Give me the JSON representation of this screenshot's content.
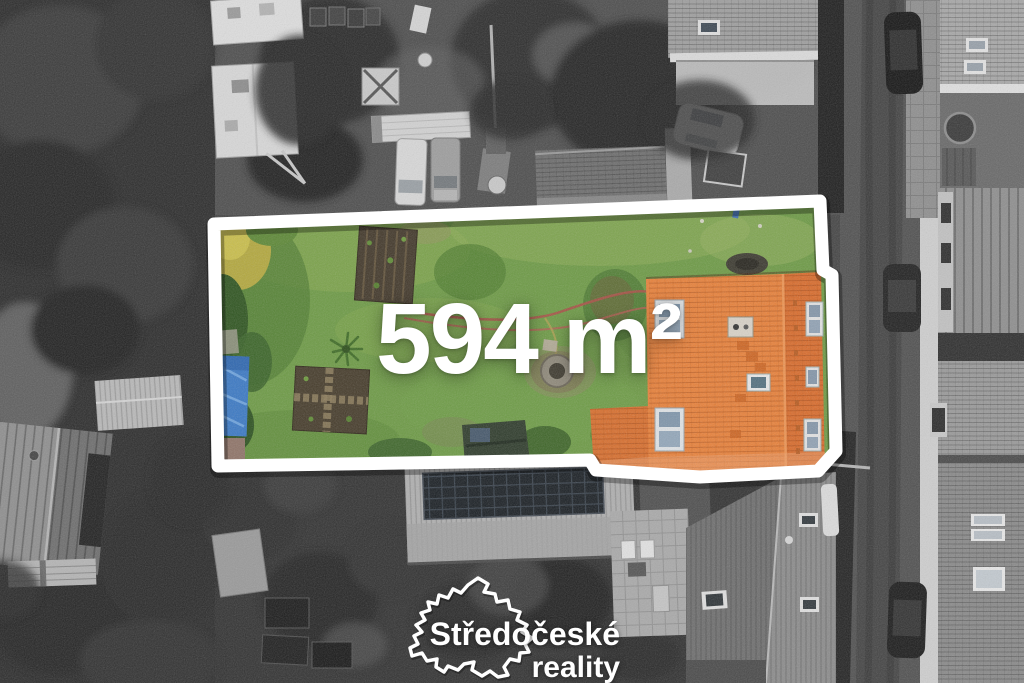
{
  "overlay": {
    "area_label": "594 m²",
    "text_color": "#ffffff",
    "plot_outline_color": "#ffffff"
  },
  "watermark": {
    "brand_line1": "Středočeské",
    "brand_line2": "reality",
    "map_icon": "central-bohemia-region-outline",
    "text_color": "#ffffff"
  },
  "scene": {
    "style": "aerial-drone-photo, plot in color, surroundings desaturated",
    "colors": {
      "grass": "#6d9a45",
      "house_roof": "#e4792f",
      "tarp": "#3b79c4",
      "road": "#4f4f4f",
      "trees": "#2b2b2b"
    },
    "elements": [
      "plot-boundary-outline",
      "orange-roof-house",
      "garden-bed",
      "blue-tarp",
      "garden-hose",
      "stone-well",
      "yucca-plant",
      "yellow-tree",
      "road",
      "parked-car",
      "sidewalk",
      "caravan",
      "camper-trailer",
      "white-van",
      "gray-van",
      "garden-shed",
      "metal-barn",
      "solar-panel-roof",
      "neighbor-house",
      "patio",
      "trees"
    ]
  }
}
